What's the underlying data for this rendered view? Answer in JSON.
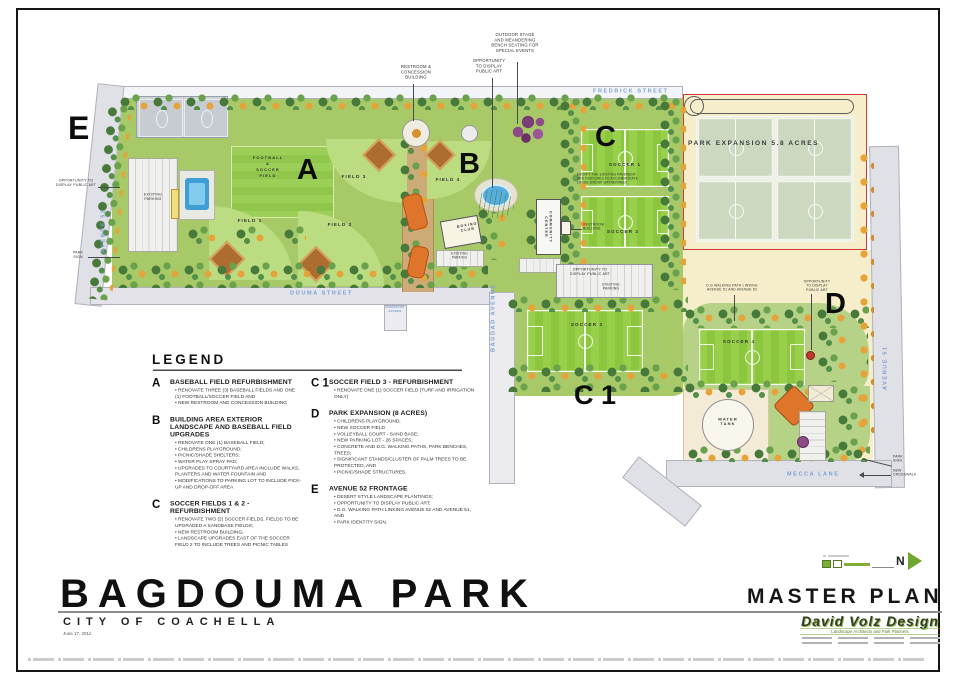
{
  "colors": {
    "boundary_red": "#d23a32",
    "street_label_blue": "#7b9fd4",
    "park_green": "#a7c967",
    "pitch_green": "#8cc53e",
    "parcel_tan": "#f6eecb",
    "logo_green": "#6fa62f"
  },
  "title_block": {
    "park_name": "BAGDOUMA PARK",
    "city": "CITY OF COACHELLA",
    "date": "June 17, 2011",
    "plan_type": "MASTER PLAN"
  },
  "firm": {
    "name": "David Volz Design",
    "tagline": "Landscape Architects and Park Planners"
  },
  "compass": {
    "north": "N"
  },
  "streets": {
    "fredrick": "FREDRICK STREET",
    "douma": "DOUMA STREET",
    "damascus": "DAMASCUS\nAVENUE",
    "bagdad": "BAGDAD AVENUE",
    "avenue52": "AVENUE 52",
    "avenue51": "AVENUE 51",
    "mecca": "MECCA LANE"
  },
  "plan": {
    "markers": {
      "a": "A",
      "b": "B",
      "c": "C",
      "c1": "C 1",
      "d": "D",
      "e": "E"
    },
    "labels": {
      "football": "FOOTBALL\n&\nSOCCER\nFIELD",
      "field1": "FIELD 1",
      "field2": "FIELD 2",
      "field3": "FIELD 3",
      "field4": "FIELD 4",
      "soccer1": "SOCCER 1",
      "soccer2": "SOCCER 2",
      "soccer3": "SOCCER 3",
      "soccer4": "SOCCER 4",
      "boxing_club": "BOXING\nCLUB",
      "community_center": "COMMUNITY\nCENTER",
      "water_tank": "WATER\nTANK",
      "expansion": "PARK EXPANSION 5.8 ACRES"
    },
    "callouts": {
      "outdoor_stage": "OUTDOOR STAGE\nAND MEANDERING\nBENCH SEATING FOR\nSPECIAL EVENTS",
      "public_art_top": "OPPORTUNITY\nTO DISPLAY\nPUBLIC ART",
      "restroom_concession": "RESTROOM &\nCONCESSION\nBUILDING",
      "public_art_west": "OPPORTUNITY TO\nDISPLAY PUBLIC ART",
      "park_sign_west": "PARK\nSIGN",
      "existing_parking": "EXISTING\nPARKING",
      "modify_note": "MODIFY THE EXISTING PAVEMENT\nAND FEATURES TO ACCOMMODATE\nLARGE GROUP GATHERINGS",
      "restroom_building": "RESTROOM\nBUILDING",
      "public_art_parking": "OPPORTUNITY TO\nDISPLAY PUBLIC ART",
      "dg_path": "D.G WALKING PATH LINKING\nAVENUE 51 AND AVENUE 52",
      "public_art_east": "OPPORTUNITY\nTO DISPLAY\nPUBLIC ART",
      "park_sign_east": "PARK\nSIGN",
      "new_crosswalk": "NEW\nCROSSWALK"
    }
  },
  "legend": {
    "heading": "LEGEND",
    "columns": [
      {
        "items": [
          {
            "marker": "A",
            "title": "BASEBALL FIELD REFURBISHMENT",
            "bullets": [
              "RENOVATE THREE (3) BASEBALL FIELDS AND ONE (1) FOOTBALL/SOCCER FIELD AND",
              "NEW RESTROOM AND CONCESSION BUILDING"
            ]
          },
          {
            "marker": "B",
            "title": "BUILDING AREA EXTERIOR LANDSCAPE AND BASEBALL FIELD UPGRADES",
            "bullets": [
              "RENOVATE ONE (1) BASEBALL FIELD;",
              "CHILDRENS PLAYGROUND;",
              "PICNIC/SHADE SHELTERS;",
              "WATER PLAY SPRAY PAD;",
              "UPGRADES TO COURTYARD AREA INCLUDE WALKS, PLANTERS AND WATER FOUNTAIN AND",
              "MODIFICATIONS TO PARKING LOT TO INCLUDE PICK-UP AND DROP-OFF AREA"
            ]
          },
          {
            "marker": "C",
            "title": "SOCCER FIELDS 1 & 2 -  REFURBISHMENT",
            "bullets": [
              "RENOVATE TWO (2) SOCCER FIELDS, FIELDS TO BE UPGRADED A SANDBASE FIELDS;",
              "NEW RESTROOM BUILDING;",
              "LANDSCAPE UPGRADES EAST OF THE SOCCER FIELD 2 TO INCLUDE TREES AND PICNIC TABLES"
            ]
          }
        ]
      },
      {
        "items": [
          {
            "marker": "C 1",
            "title": "SOCCER FIELD 3 - REFURBISHMENT",
            "bullets": [
              "RENOVATE ONE (1) SOCCER FIELD (TURF AND IRRIGATION ONLY)"
            ]
          },
          {
            "marker": "D",
            "title": "PARK EXPANSION (8 ACRES)",
            "bullets": [
              "CHILDRENS PLAYGROUND;",
              "NEW SOCCER FIELD",
              "VOLLEYBALL COURT - SAND BASE;",
              "NEW PARKING LOT - 26 SPACES;",
              "CONCRETE AND D.G. WALKING PATHS, PARK BENCHES, TREES;",
              "SIGNIFICANT STANDS/CLUSTER OF PALM TREES TO BE PROTECTED, AND",
              "PICNIC/SHADE STRUCTURES."
            ]
          },
          {
            "marker": "E",
            "title": "AVENUE 52 FRONTAGE",
            "bullets": [
              "DESERT STYLE LANDSCAPE PLANTINGS;",
              "OPPORTUNITY TO DISPLAY PUBLIC ART;",
              "D.G. WALKING PATH LINKING AVENUE 52 AND AVENUE 51, AND",
              "PARK IDENTITY SIGN."
            ]
          }
        ]
      }
    ]
  }
}
